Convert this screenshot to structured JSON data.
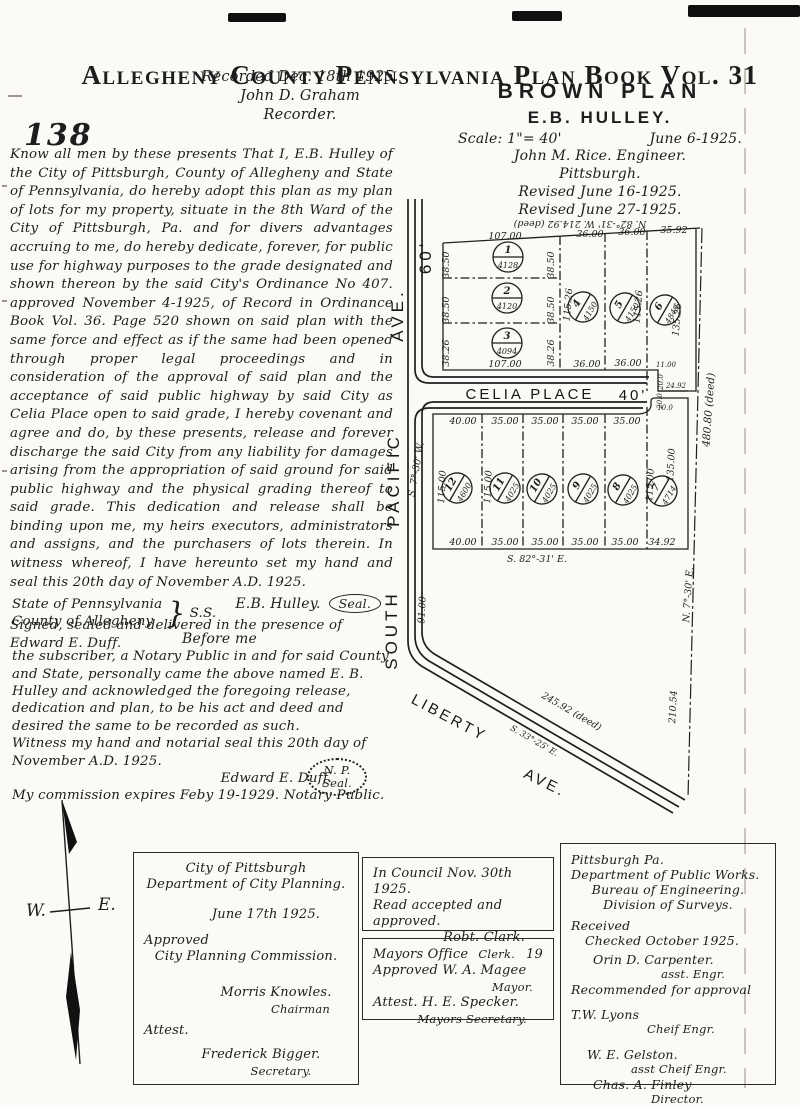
{
  "page": {
    "number": "138"
  },
  "header": {
    "title": "Allegheny County Pennsylvania Plan Book Vol. 31"
  },
  "recorded": {
    "line1": "Recorded Dec. 18th 1925.",
    "line2": "John D. Graham",
    "line3": "Recorder."
  },
  "plan_title": {
    "name": "BROWN PLAN",
    "owner": "E.B. HULLEY.",
    "scale": "Scale: 1\"= 40'",
    "date": "June 6-1925.",
    "engineer": "John M. Rice. Engineer.",
    "city": "Pittsburgh.",
    "revised1": "Revised June 16-1925.",
    "revised2": "Revised June 27-1925."
  },
  "dedication": {
    "body": "Know all men by these presents That I, E.B. Hulley of the City of Pittsburgh, County of Allegheny and State of Pennsylvania, do hereby adopt this plan as my plan of lots for my property, situate in the 8th Ward of the City of Pittsburgh, Pa. and for divers advantages accruing to me, do hereby dedicate, forever, for public use for highway purposes to the grade designated and shown thereon by the said City's Ordinance No 407. approved November 4-1925, of Record in Ordinance Book Vol. 36. Page 520 shown on said plan with the same force and effect as if the same had been opened through proper legal proceedings and in consideration of the approval of said plan and the acceptance of said public highway by said City as Celia Place open to said grade, I hereby covenant and agree and do, by these presents, release and forever discharge the said City from any liability for damages arising from the appropriation of said ground for said public highway and the physical grading thereof to said grade. This dedication and release shall be binding upon me, my heirs executors, administrators and assigns, and the purchasers of lots therein. In witness whereof, I have hereunto set my hand and seal this 20th day of November A.D. 1925.",
    "signature": "E.B. Hulley.",
    "seal": "Seal.",
    "witness": "Signed, sealed and delivered in the presence of Edward E. Duff."
  },
  "notary": {
    "state": "State of Pennsylvania",
    "county": "County of Allegheny",
    "ss": "S.S.",
    "before": "Before me",
    "body": "the subscriber, a Notary Public in and for said County and State, personally came the above named E. B. Hulley and acknowledged the foregoing release, dedication and plan, to be his act and deed and desired the same to be recorded as such.",
    "witness": "Witness my hand and notarial seal this 20th day of November A.D. 1925.",
    "signature": "Edward E. Duff.",
    "commission": "My commission expires Feby 19-1929. Notary Public.",
    "seal_line1": "N. P.",
    "seal_line2": "Seal."
  },
  "compass": {
    "west": "W.",
    "east": "E."
  },
  "map": {
    "streets": {
      "south": "SOUTH",
      "pacific": "PACIFIC",
      "ave_left": "AVE.",
      "sixty": "60'",
      "celia": "CELIA   PLACE",
      "celia_width": "40'",
      "liberty": "LIBERTY",
      "ave_liberty": "AVE."
    },
    "dims": {
      "deed_top": "N. 82°-31' W.   214.92 (deed)",
      "u_col_top": "107.00",
      "u_col_bottom": "107.00",
      "u_side": [
        "38.50",
        "38.50",
        "38.26"
      ],
      "u_top": [
        "36.00",
        "36.00",
        "35.92"
      ],
      "u_bottom": [
        "36.00",
        "36.00",
        "11.00"
      ],
      "u_vert": [
        "115.26",
        "115.26",
        "135.26"
      ],
      "jog_a": "20.0",
      "jog_b": "24.92",
      "jog_c": "20.0",
      "jog_d": "10.0",
      "l_top": [
        "40.00",
        "35.00",
        "35.00",
        "35.00",
        "35.00"
      ],
      "l_bottom": [
        "40.00",
        "35.00",
        "35.00",
        "35.00",
        "35.00",
        "34.92"
      ],
      "l_vert": [
        "115.00",
        "115.00",
        "115.00",
        "135.00"
      ],
      "bearing_bottom": "S. 82°-31' E.",
      "bearing_left": "S. 7°-30' W.",
      "sp_dim": "91.00",
      "deed_right": "480.80 (deed)",
      "bearing_right": "N. 7°-30' E.",
      "d_210": "210.54",
      "liberty_len": "245.92  (deed)",
      "bearing_liberty": "S. 33°-25' E."
    },
    "lots": [
      {
        "number": "1",
        "area": "4128"
      },
      {
        "number": "2",
        "area": "4120"
      },
      {
        "number": "3",
        "area": "4094"
      },
      {
        "number": "4",
        "area": "4150"
      },
      {
        "number": "5",
        "area": "4150"
      },
      {
        "number": "6",
        "area": "4849"
      },
      {
        "number": "7",
        "area": "4714"
      },
      {
        "number": "8",
        "area": "4025"
      },
      {
        "number": "9",
        "area": "4025"
      },
      {
        "number": "10",
        "area": "4025"
      },
      {
        "number": "11",
        "area": "4025"
      },
      {
        "number": "12",
        "area": "4600"
      }
    ]
  },
  "boxes": {
    "planning": {
      "line1": "City of Pittsburgh",
      "line2": "Department of City Planning.",
      "date": "June 17th 1925.",
      "approved": "Approved",
      "commission": "City Planning Commission.",
      "name1": "Morris Knowles.",
      "title1": "Chairman",
      "attest": "Attest.",
      "name2": "Frederick Bigger.",
      "title2": "Secretary."
    },
    "council": {
      "line1": "In Council Nov. 30th 1925.",
      "line2": "Read accepted and approved.",
      "name": "Robt. Clark.",
      "title": "Clerk."
    },
    "mayor": {
      "office": "Mayors Office",
      "num": "19",
      "approved": "Approved W. A. Magee",
      "title1": "Mayor.",
      "attest": "Attest.  H. E. Specker.",
      "title2": "Mayors Secretary."
    },
    "publicworks": {
      "line1": "Pittsburgh Pa.",
      "line2": "Department of Public Works.",
      "line3": "Bureau of Engineering.",
      "line4": "Division of Surveys.",
      "received": "Received",
      "checked": "Checked October 1925.",
      "name1": "Orin D. Carpenter.",
      "title1": "asst. Engr.",
      "recommend": "Recommended for approval",
      "name2": "T.W. Lyons",
      "title2": "Cheif Engr.",
      "name3": "W. E. Gelston.",
      "title3": "asst Cheif Engr.",
      "name4": "Chas. A. Finley",
      "title4": "Director."
    }
  }
}
